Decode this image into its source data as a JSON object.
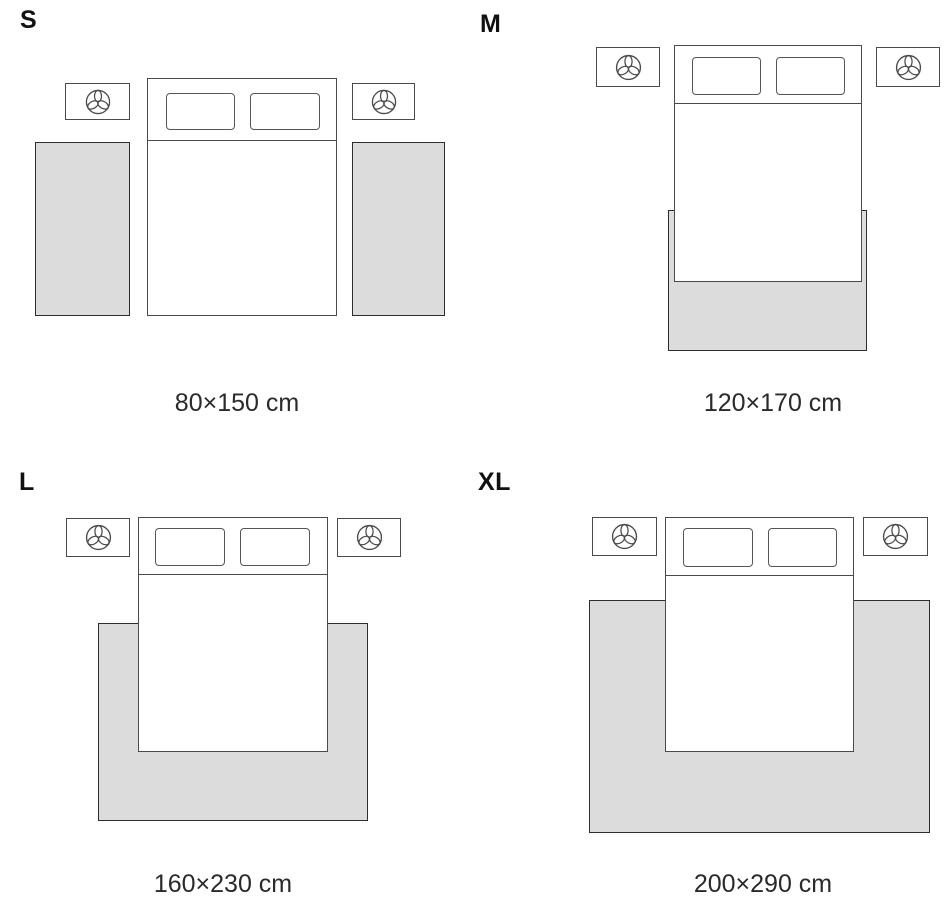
{
  "diagram": {
    "type": "rug-size-guide-bedroom",
    "variants": [
      {
        "label": "S",
        "size_text": "80×150 cm",
        "rug_width_cm": 80,
        "rug_length_cm": 150,
        "rug_count": 2,
        "placement": "two-runner-rugs-either-side-of-bed"
      },
      {
        "label": "M",
        "size_text": "120×170 cm",
        "rug_width_cm": 120,
        "rug_length_cm": 170,
        "rug_count": 1,
        "placement": "under-foot-of-bed-extending-below"
      },
      {
        "label": "L",
        "size_text": "160×230 cm",
        "rug_width_cm": 160,
        "rug_length_cm": 230,
        "rug_count": 1,
        "placement": "under-lower-part-of-bed-extending-sides-and-foot"
      },
      {
        "label": "XL",
        "size_text": "200×290 cm",
        "rug_width_cm": 200,
        "rug_length_cm": 290,
        "rug_count": 1,
        "placement": "large-rug-under-bed-spanning-past-nightstand-width"
      }
    ]
  },
  "icons": {
    "nightstand_decoration": "plant-icon"
  },
  "colors": {
    "background": "#ffffff",
    "furniture_outline": "#4a4a4a",
    "rug_outline": "#2d2d2d",
    "rug_fill": "#dcdcdc",
    "text": "#1c1c1c"
  }
}
